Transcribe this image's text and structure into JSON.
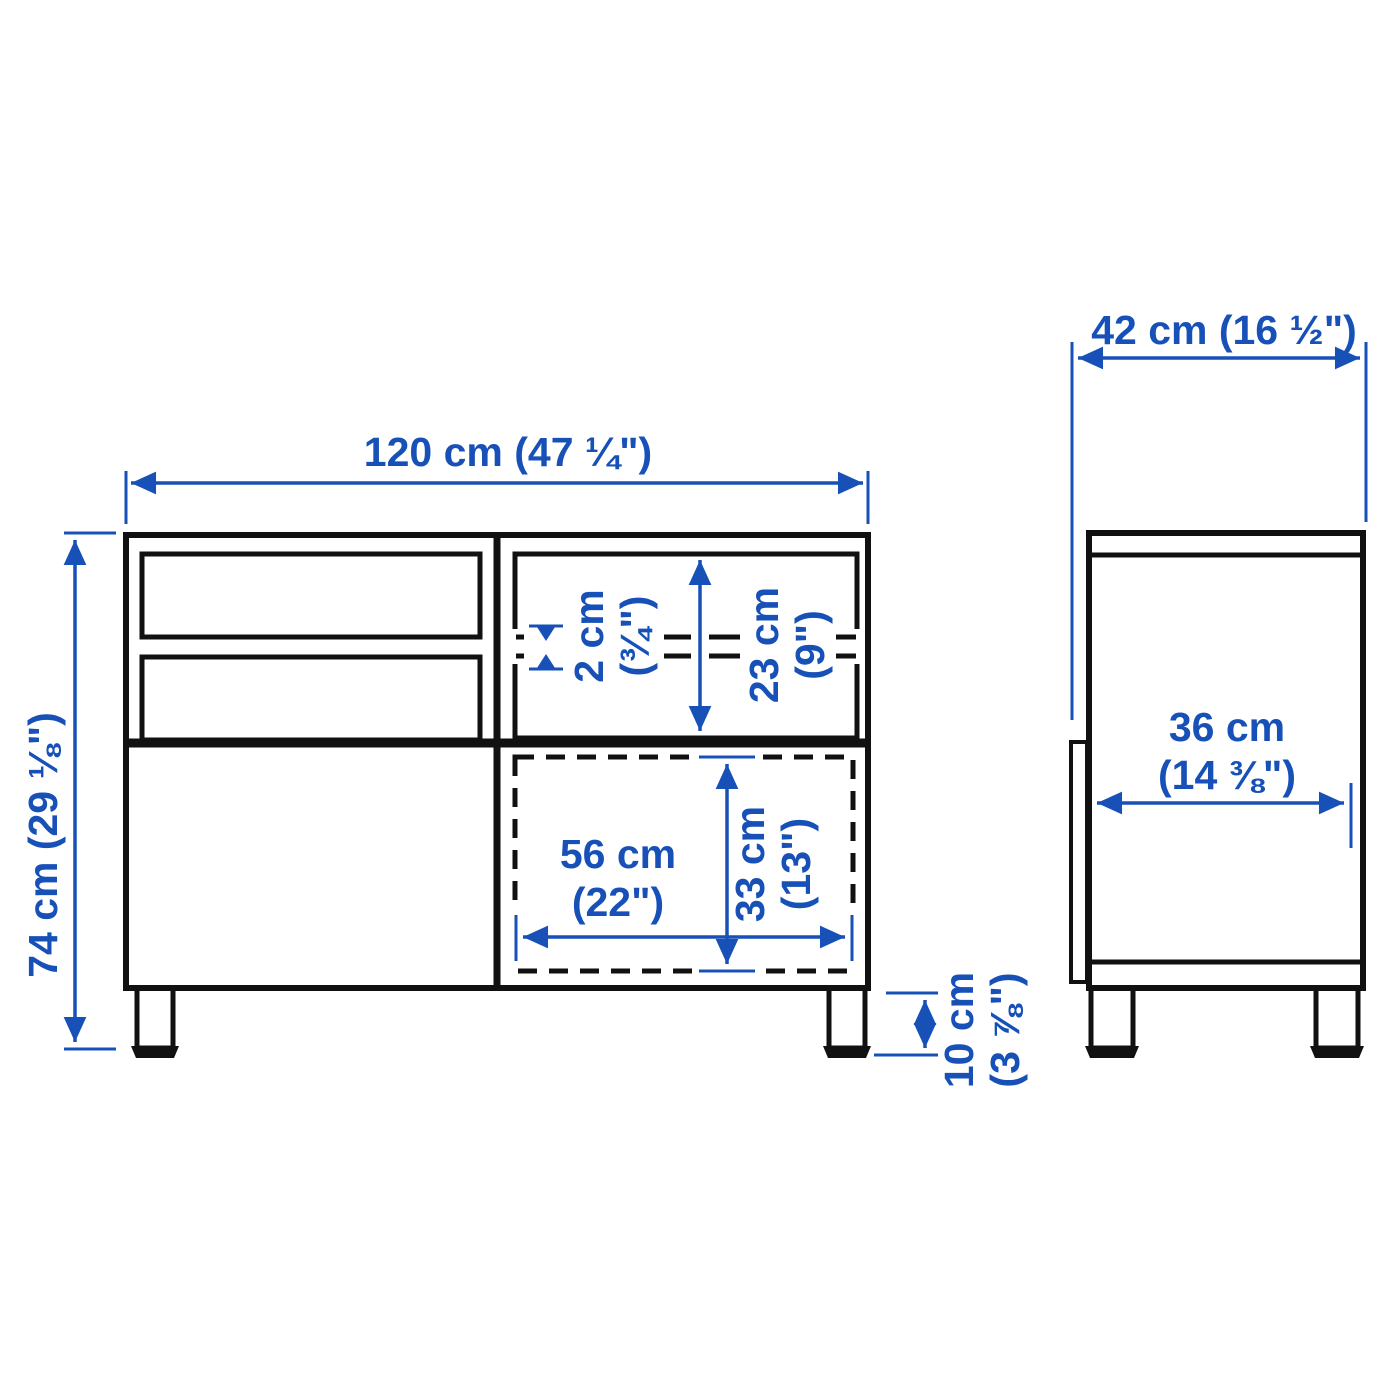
{
  "title": "Furniture dimension diagram (front and side view)",
  "colors": {
    "dimension_blue": "#1751b8",
    "line_black": "#111111",
    "background": "#ffffff"
  },
  "front_view": {
    "width_label": "120 cm (47 ¼\")",
    "height_label": "74 cm (29 ⅛\")",
    "shelf_thickness": {
      "line1": "2 cm",
      "line2": "(¾\")"
    },
    "top_compartment_height": {
      "line1": "23 cm",
      "line2": "(9\")"
    },
    "opening_width": {
      "line1": "56 cm",
      "line2": "(22\")"
    },
    "opening_height": {
      "line1": "33 cm",
      "line2": "(13\")"
    },
    "leg_height": {
      "line1": "10 cm",
      "line2": "(3 ⅞\")"
    }
  },
  "side_view": {
    "depth_label": "42 cm (16 ½\")",
    "interior_depth": {
      "line1": "36 cm",
      "line2": "(14 ⅜\")"
    }
  }
}
